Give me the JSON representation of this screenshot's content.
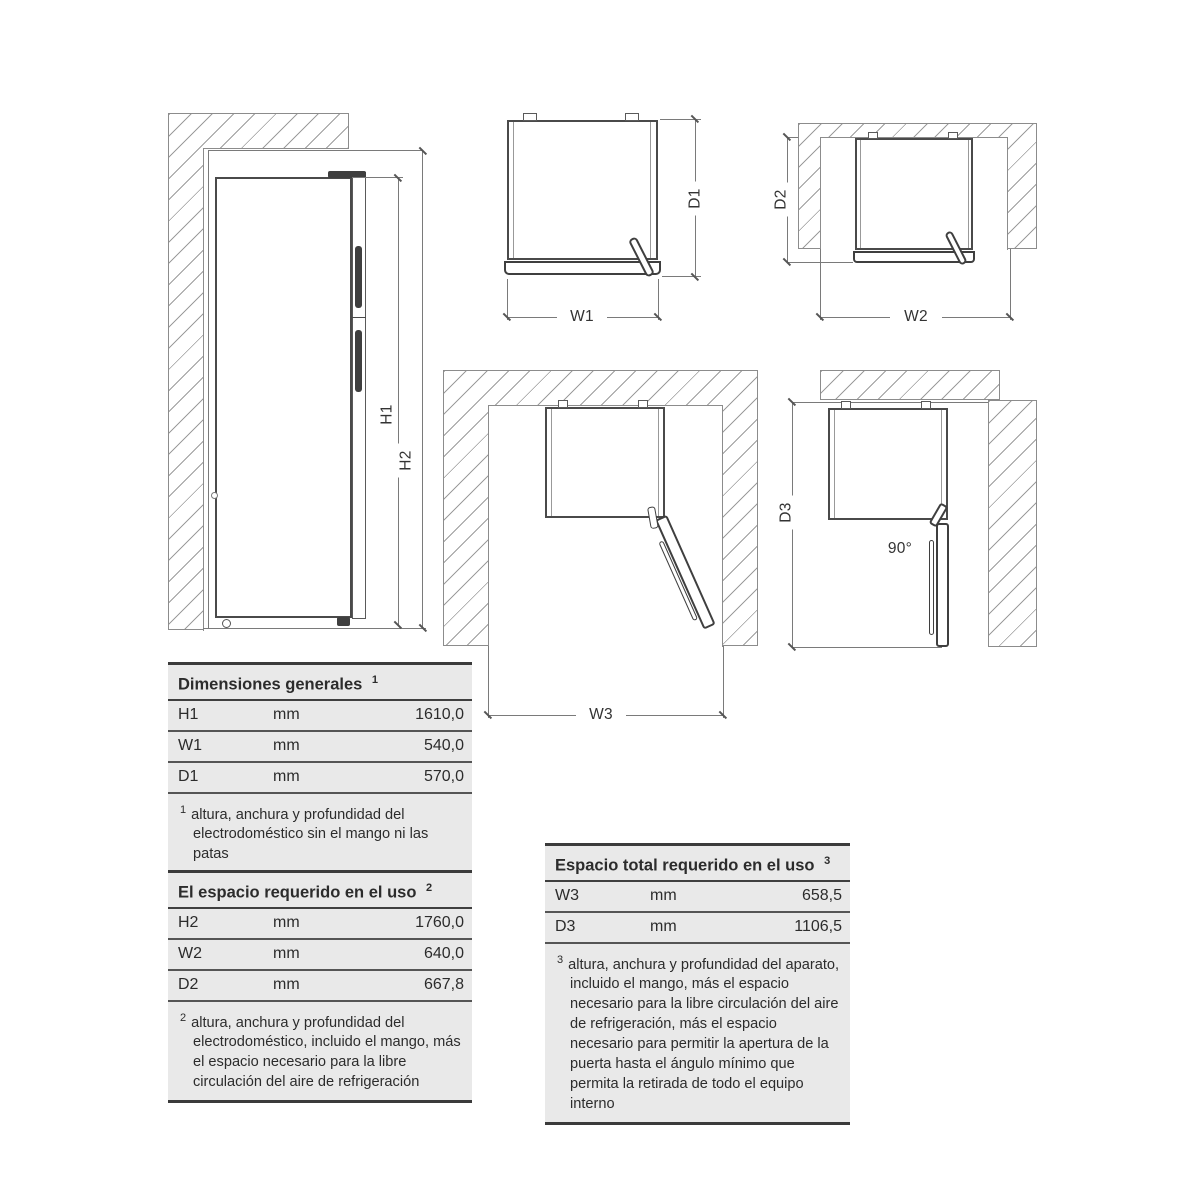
{
  "diagram_labels": {
    "h1": "H1",
    "h2": "H2",
    "w1": "W1",
    "d1": "D1",
    "w2": "W2",
    "d2": "D2",
    "w3": "W3",
    "d3": "D3",
    "angle": "90°"
  },
  "tables": {
    "general": {
      "title": "Dimensiones generales",
      "title_sup": "1",
      "rows": [
        {
          "label": "H1",
          "unit": "mm",
          "value": "1610,0"
        },
        {
          "label": "W1",
          "unit": "mm",
          "value": "540,0"
        },
        {
          "label": "D1",
          "unit": "mm",
          "value": "570,0"
        }
      ],
      "footnote_sup": "1",
      "footnote": "altura, anchura y profundidad del electrodoméstico sin el mango ni las patas"
    },
    "required": {
      "title": "El espacio requerido en el uso",
      "title_sup": "2",
      "rows": [
        {
          "label": "H2",
          "unit": "mm",
          "value": "1760,0"
        },
        {
          "label": "W2",
          "unit": "mm",
          "value": "640,0"
        },
        {
          "label": "D2",
          "unit": "mm",
          "value": "667,8"
        }
      ],
      "footnote_sup": "2",
      "footnote": "altura, anchura y profundidad del electrodoméstico, incluido el mango, más el espacio necesario para la libre circulación del aire de refrigeración"
    },
    "total": {
      "title": "Espacio total requerido en el uso",
      "title_sup": "3",
      "rows": [
        {
          "label": "W3",
          "unit": "mm",
          "value": "658,5"
        },
        {
          "label": "D3",
          "unit": "mm",
          "value": "1106,5"
        }
      ],
      "footnote_sup": "3",
      "footnote": "altura, anchura y profundidad del aparato, incluido el mango, más el espacio necesario para la libre circulación del aire de refrigeración, más el espacio necesario para permitir la apertura de la puerta hasta el ángulo mínimo que permita la retirada de todo el equipo interno"
    }
  },
  "colors": {
    "table_background": "#e9e9e9",
    "drawing_line": "#7a7a7a",
    "dark_detail": "#3f3f3f"
  }
}
